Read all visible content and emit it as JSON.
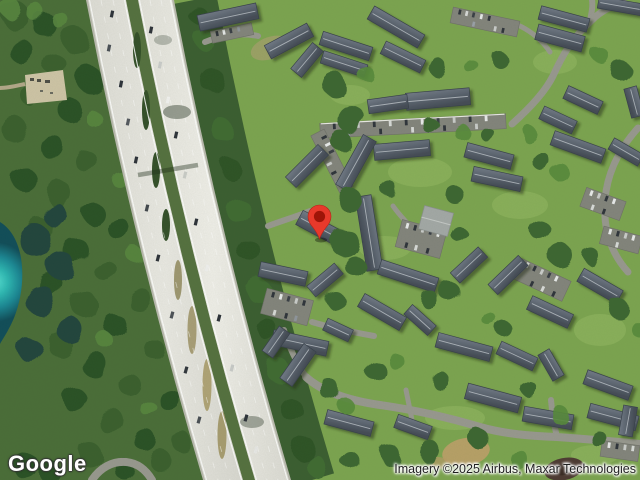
{
  "window": {
    "width": 640,
    "height": 480
  },
  "map": {
    "view_type": "satellite",
    "marker": {
      "label": "location-pin",
      "color": "#E8392B",
      "inner_color": "#9E1408",
      "tip_x": 320,
      "tip_y": 239
    },
    "palette": {
      "forest": "#4a6d38",
      "forest_dark": "#2c4f3a",
      "grass": "#7ca450",
      "water_bright": "#3ecac0",
      "water_deep": "#124d59",
      "highway_pavement": "#e5e4de",
      "local_road": "#98988f",
      "roof_gray": "#5b6470",
      "parking_gray": "#83847c"
    }
  },
  "footer": {
    "logo_text": "Google",
    "attribution_text": "Imagery ©2025 Airbus, Maxar Technologies"
  }
}
